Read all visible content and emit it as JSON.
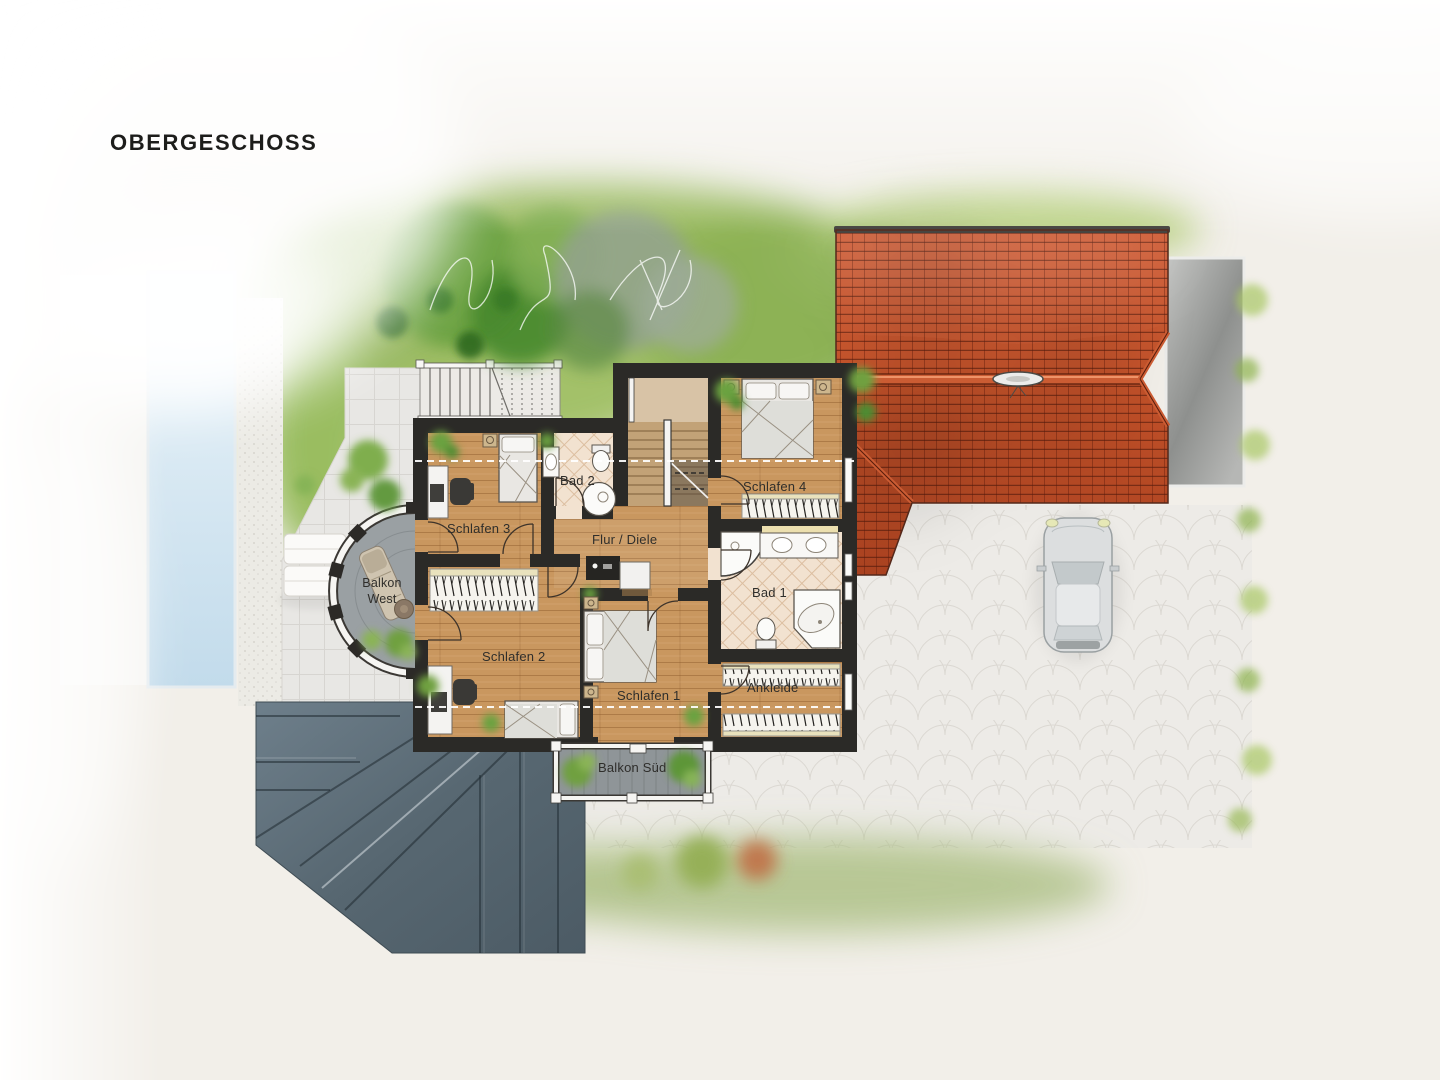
{
  "page": {
    "title": "OBERGESCHOSS",
    "background_color": "#f2efe9"
  },
  "floor_plan": {
    "rooms": [
      {
        "id": "schlafen-3",
        "label": "Schlafen 3"
      },
      {
        "id": "bad-2",
        "label": "Bad 2"
      },
      {
        "id": "flur-diele",
        "label": "Flur / Diele"
      },
      {
        "id": "schlafen-4",
        "label": "Schlafen 4"
      },
      {
        "id": "bad-1",
        "label": "Bad 1"
      },
      {
        "id": "schlafen-2",
        "label": "Schlafen 2"
      },
      {
        "id": "schlafen-1",
        "label": "Schlafen 1"
      },
      {
        "id": "ankleide",
        "label": "Ankleide"
      },
      {
        "id": "balkon-west",
        "label": "Balkon West"
      },
      {
        "id": "balkon-sued",
        "label": "Balkon Süd"
      }
    ],
    "colors": {
      "wall": "#2b2a27",
      "wood_floor": "#c9975f",
      "tile_floor": "#f2e2d0",
      "garage_roof_red": "#c25129",
      "ground_roof_slate": "#5a6b76",
      "lawn_green": "#8fb356",
      "pool_blue": "#cfe3f0",
      "driveway": "#edebe7",
      "terrace": "#e8e7e4"
    }
  }
}
